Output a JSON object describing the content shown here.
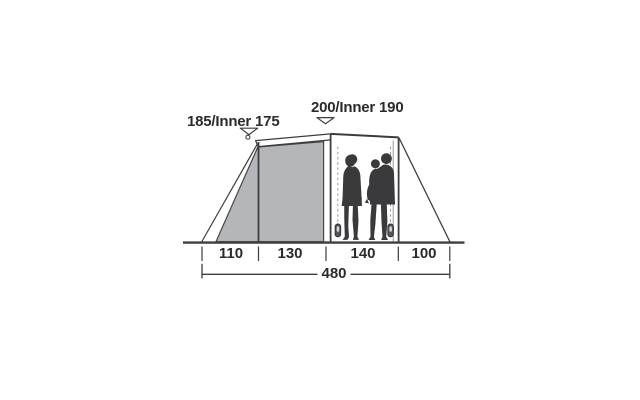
{
  "labels": {
    "porch_height": "185/Inner 175",
    "main_height": "200/Inner 190"
  },
  "measurements": {
    "segments": [
      {
        "value": "110"
      },
      {
        "value": "130"
      },
      {
        "value": "140"
      },
      {
        "value": "100"
      }
    ],
    "total_width": "480"
  },
  "icons": {
    "porch_arrow": "down-arrow",
    "main_arrow": "down-arrow"
  },
  "colors": {
    "background": "#ffffff",
    "fabric_gray": "#b4b6b9",
    "line": "#3d3d40",
    "silhouette": "#3a3a3c",
    "text": "#2b2b2b",
    "zipper_dash": "#9b9b9b"
  }
}
